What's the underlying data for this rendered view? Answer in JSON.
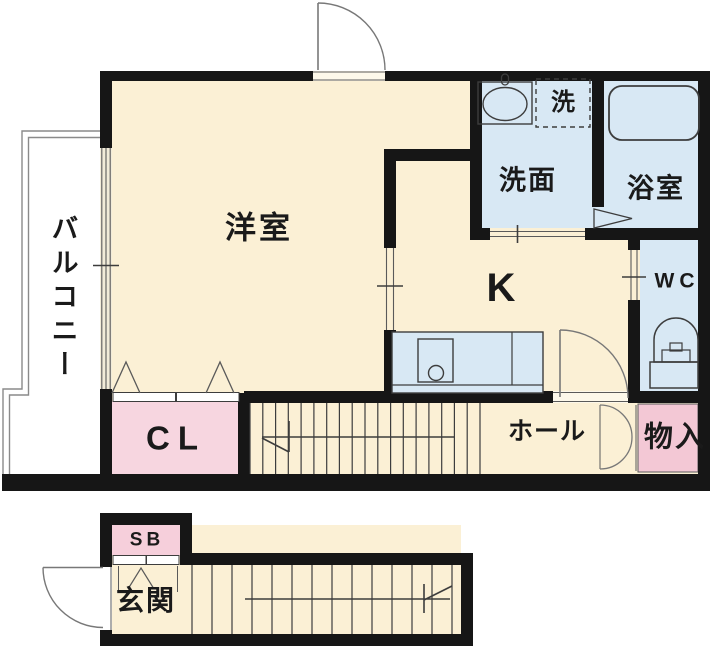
{
  "figure": {
    "type": "apartment-floor-plan"
  },
  "colors": {
    "wall": "#161616",
    "floor_cream": "#fbf0d5",
    "wet_area_blue": "#d8e8f4",
    "closet_pink": "#f7d6e0",
    "storage_pink": "#f3c8d5",
    "shoebox_pink": "#f6cfdb",
    "line_dark": "#3d3d3d",
    "thin_gray": "#5a5a5a",
    "door_arc_gray": "#787878",
    "balcony_outline_gray": "#8a8a8a",
    "text_ink": "#1a1a1a"
  },
  "rooms": {
    "balcony": {
      "label": "バルコニー"
    },
    "western_room": {
      "label": "洋室"
    },
    "washroom": {
      "label": "洗面"
    },
    "washer": {
      "label": "洗"
    },
    "bathroom": {
      "label": "浴室"
    },
    "kitchen": {
      "label": "K"
    },
    "toilet": {
      "label": "WC"
    },
    "closet": {
      "label": "CL"
    },
    "hall": {
      "label": "ホール"
    },
    "storage": {
      "label": "物入"
    },
    "shoebox": {
      "label": "SB"
    },
    "entrance": {
      "label": "玄関"
    }
  }
}
